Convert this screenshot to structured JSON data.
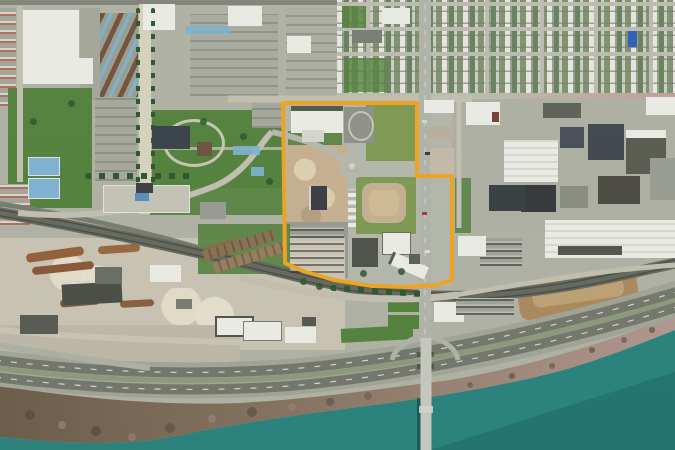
{
  "title": "Aerial photograph of riverfront district with development parcel highlighted in yellow",
  "canvas": {
    "width": 675,
    "height": 450
  },
  "palette": {
    "urban": "#B2B5A8",
    "roofw": "#EFF0EA",
    "grass": "#55843F",
    "olive": "#7F9C55",
    "water": "#2B847E",
    "waterdeep": "#1E6E6B",
    "shorebrown": "#76654F",
    "shorepink": "#B29890",
    "asphalt": "#75796F",
    "roadlight": "#C6C3B4",
    "rail": "#666A60",
    "tree": "#2E5830",
    "yellow": "#F3A722",
    "court": "#7FB6D6",
    "dirttan": "#C9B493",
    "dirtbrown": "#AE8B60"
  },
  "parcel_outline": {
    "color": "#F3A722",
    "stroke_width": 4,
    "points": [
      [
        283,
        103
      ],
      [
        417,
        103
      ],
      [
        417,
        176
      ],
      [
        452,
        176
      ],
      [
        452,
        280
      ],
      [
        436,
        285
      ],
      [
        408,
        287
      ],
      [
        372,
        286
      ],
      [
        334,
        280
      ],
      [
        303,
        271
      ],
      [
        285,
        263
      ]
    ]
  }
}
